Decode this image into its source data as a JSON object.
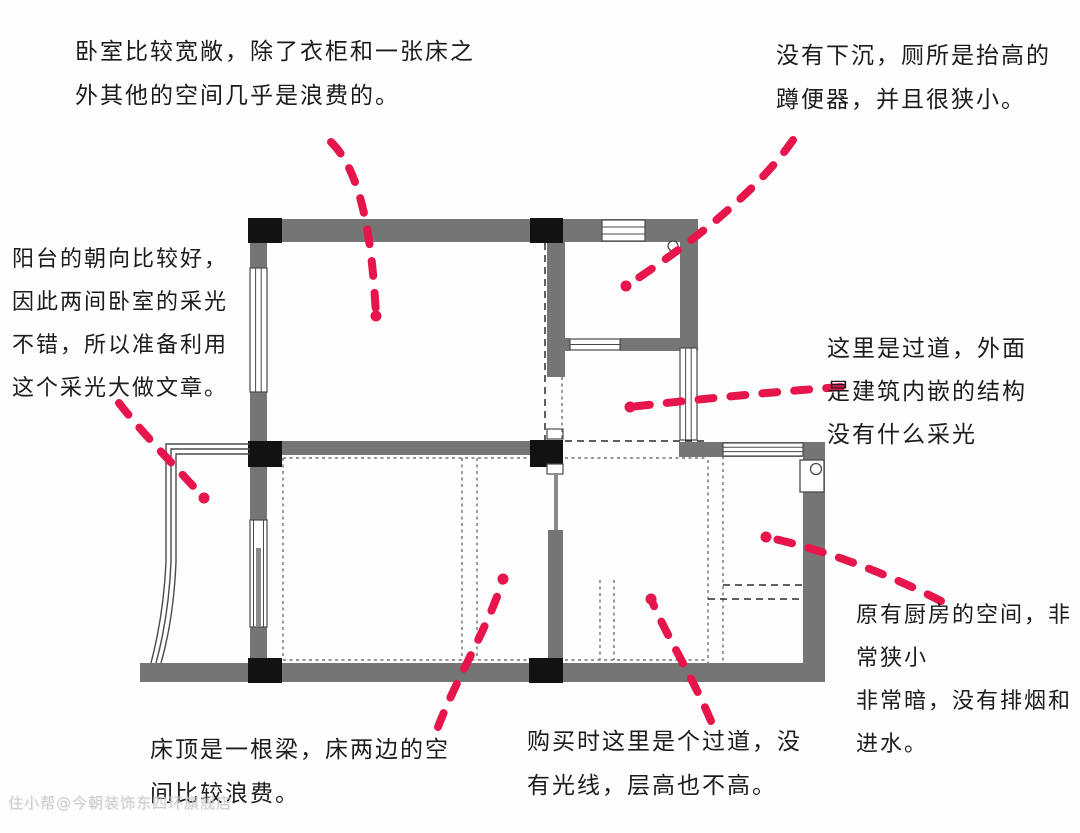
{
  "notes": {
    "bedroom": {
      "lines": [
        "卧室比较宽敞，除了衣柜和一张床之",
        "外其他的空间几乎是浪费的。"
      ]
    },
    "toilet": {
      "lines": [
        "没有下沉，厕所是抬高的",
        "蹲便器，并且很狭小。"
      ]
    },
    "balcony": {
      "lines": [
        "阳台的朝向比较好，",
        "因此两间卧室的采光",
        "不错，所以准备利用",
        "这个采光大做文章。"
      ]
    },
    "corridor": {
      "lines": [
        "这里是过道，外面",
        "是建筑内嵌的结构",
        "没有什么采光"
      ]
    },
    "kitchen": {
      "lines": [
        "原有厨房的空间，非",
        "常狭小",
        "非常暗，没有排烟和",
        "进水。"
      ]
    },
    "passage": {
      "lines": [
        "购买时这里是个过道，没",
        "有光线，层高也不高。"
      ]
    },
    "beam": {
      "lines": [
        "床顶是一根梁，床两边的空",
        "间比较浪费。"
      ]
    }
  },
  "watermark": "住小帮@今朝装饰东四环旗舰店",
  "colors": {
    "arrow": "#e6164c",
    "wall": "#757575",
    "pillar": "#121212",
    "text": "#1c1c1c",
    "line": "#4a4a4a",
    "watermark": "#c9c9c9"
  }
}
